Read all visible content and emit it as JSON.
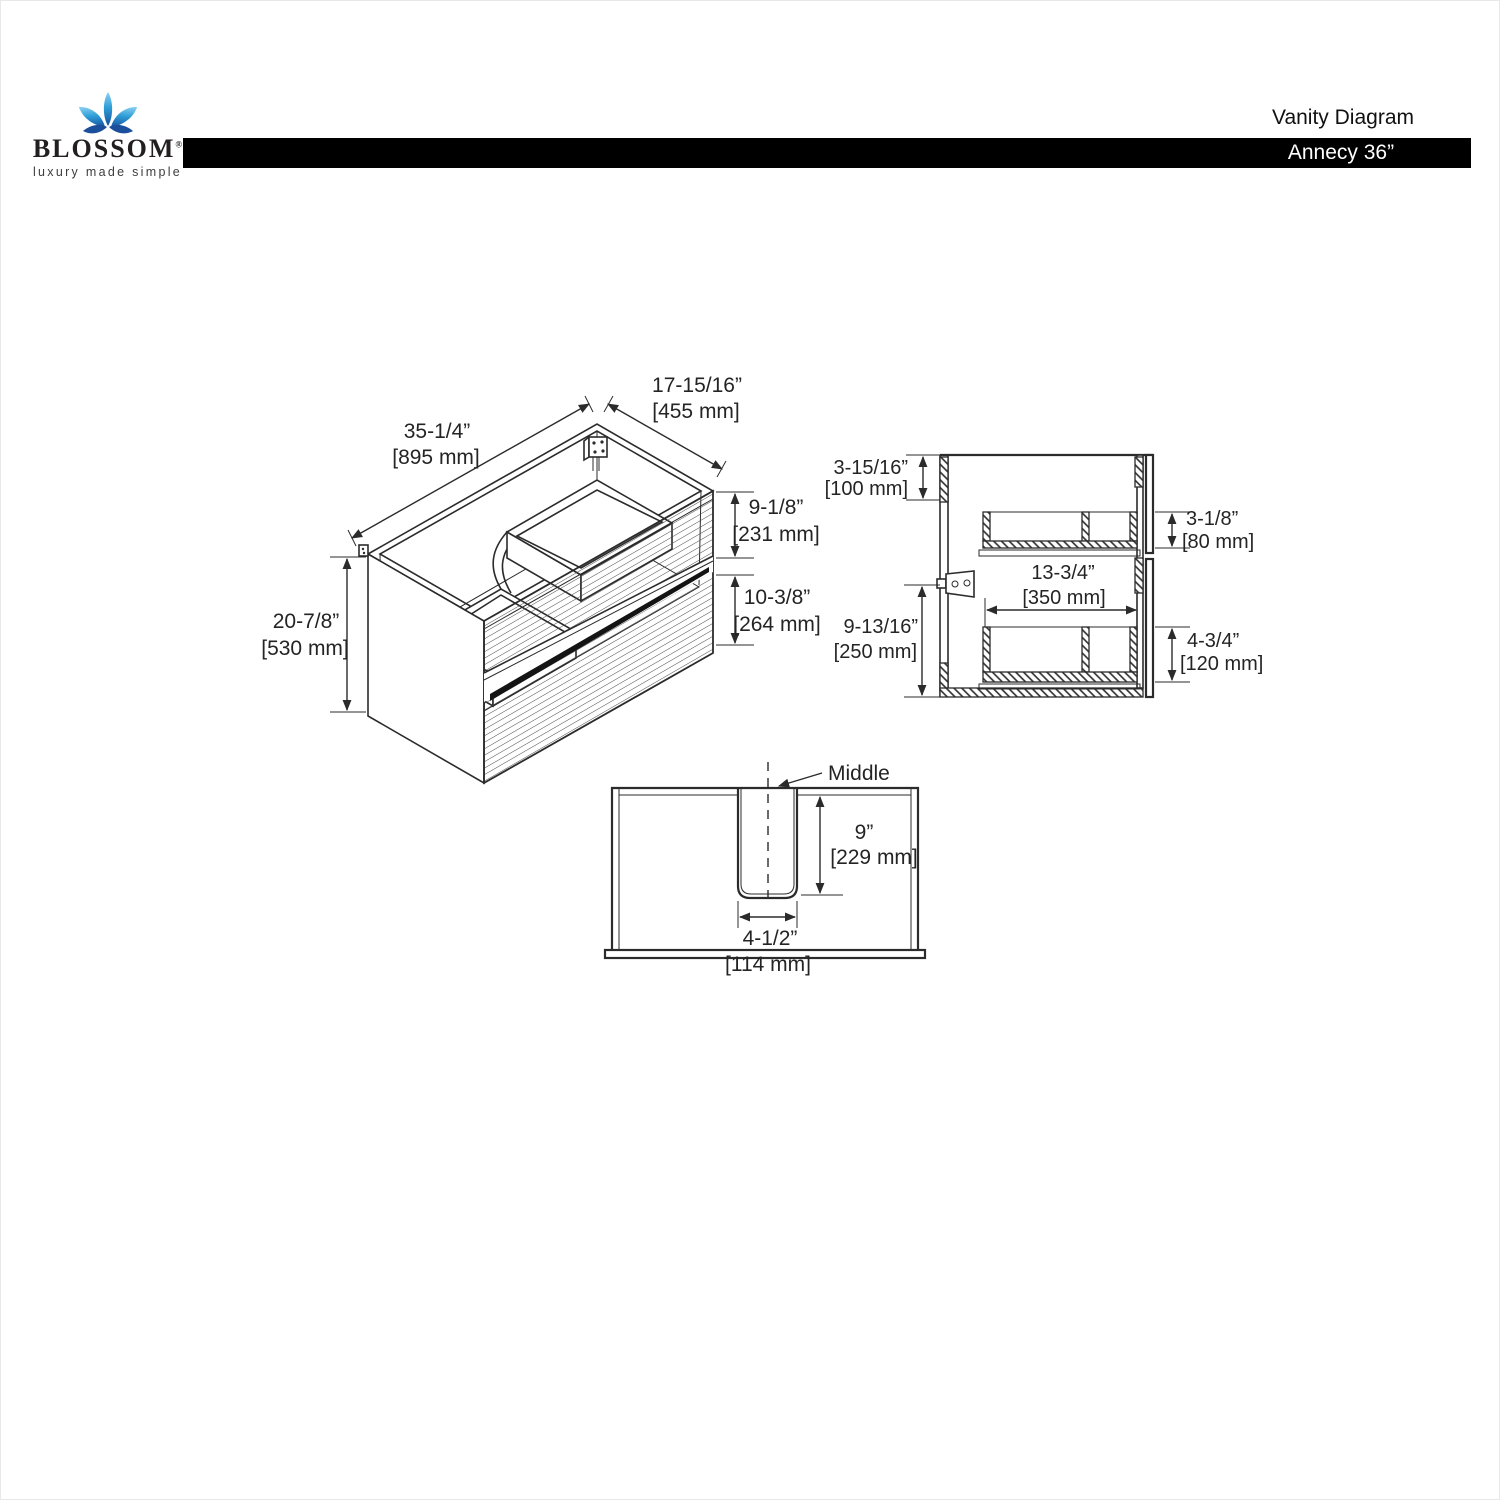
{
  "header": {
    "brand": "BLOSSOM",
    "brand_reg": "®",
    "tagline": "luxury made simple",
    "title": "Vanity Diagram",
    "model": "Annecy 36”"
  },
  "colors": {
    "line": "#2b2b2b",
    "bar": "#000000",
    "logo_blue_light": "#7ac9ef",
    "logo_blue_dark": "#1a5dad"
  },
  "iso_view": {
    "width_in": "35-1/4”",
    "width_mm": "[895 mm]",
    "depth_in": "17-15/16”",
    "depth_mm": "[455 mm]",
    "top_drawer_in": "9-1/8”",
    "top_drawer_mm": "[231 mm]",
    "bottom_drawer_in": "10-3/8”",
    "bottom_drawer_mm": "[264 mm]",
    "height_in": "20-7/8”",
    "height_mm": "[530 mm]"
  },
  "side_view": {
    "back_rail_in": "3-15/16”",
    "back_rail_mm": "[100 mm]",
    "left_height_in": "9-13/16”",
    "left_height_mm": "[250 mm]",
    "inner_width_in": "13-3/4”",
    "inner_width_mm": "[350 mm]",
    "top_drawer_in": "3-1/8”",
    "top_drawer_mm": "[80 mm]",
    "bottom_drawer_in": "4-3/4”",
    "bottom_drawer_mm": "[120 mm]"
  },
  "back_view": {
    "middle_label": "Middle",
    "slot_depth_in": "9”",
    "slot_depth_mm": "[229 mm]",
    "slot_width_in": "4-1/2”",
    "slot_width_mm": "[114 mm]"
  }
}
